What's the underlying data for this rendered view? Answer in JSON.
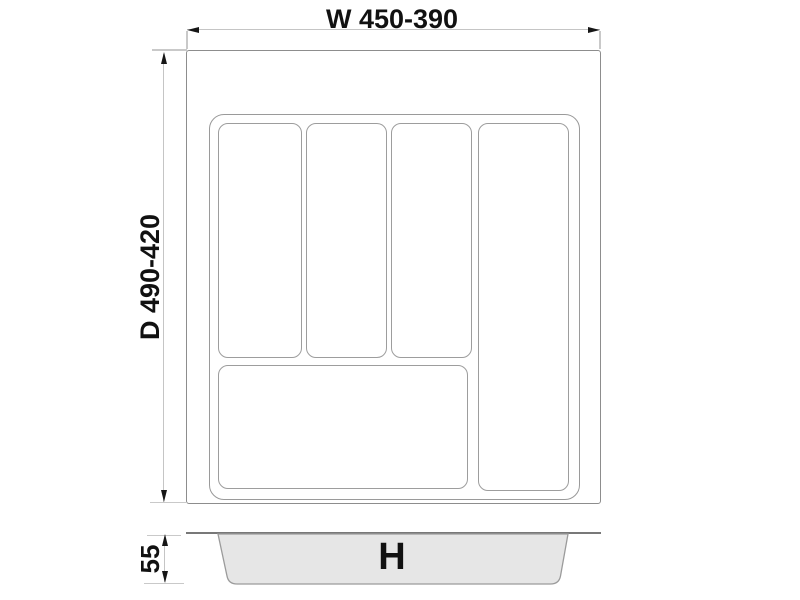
{
  "diagram": {
    "labels": {
      "width": "W 450-390",
      "depth": "D 490-420",
      "height": "55",
      "h_symbol": "H"
    },
    "top_view": {
      "description": "cutlery tray insert plan view",
      "compartment_count": 5
    },
    "side_view": {
      "description": "tray front profile"
    },
    "colors": {
      "background": "#ffffff",
      "outline_gray": "#8d8d8d",
      "compartment_gray": "#9d9d9d",
      "dimension_line_gray": "#c5c5c5",
      "arrow_text_black": "#161616",
      "profile_fill_gray": "#e6e6e6",
      "rim_dark_gray": "#787878"
    }
  }
}
